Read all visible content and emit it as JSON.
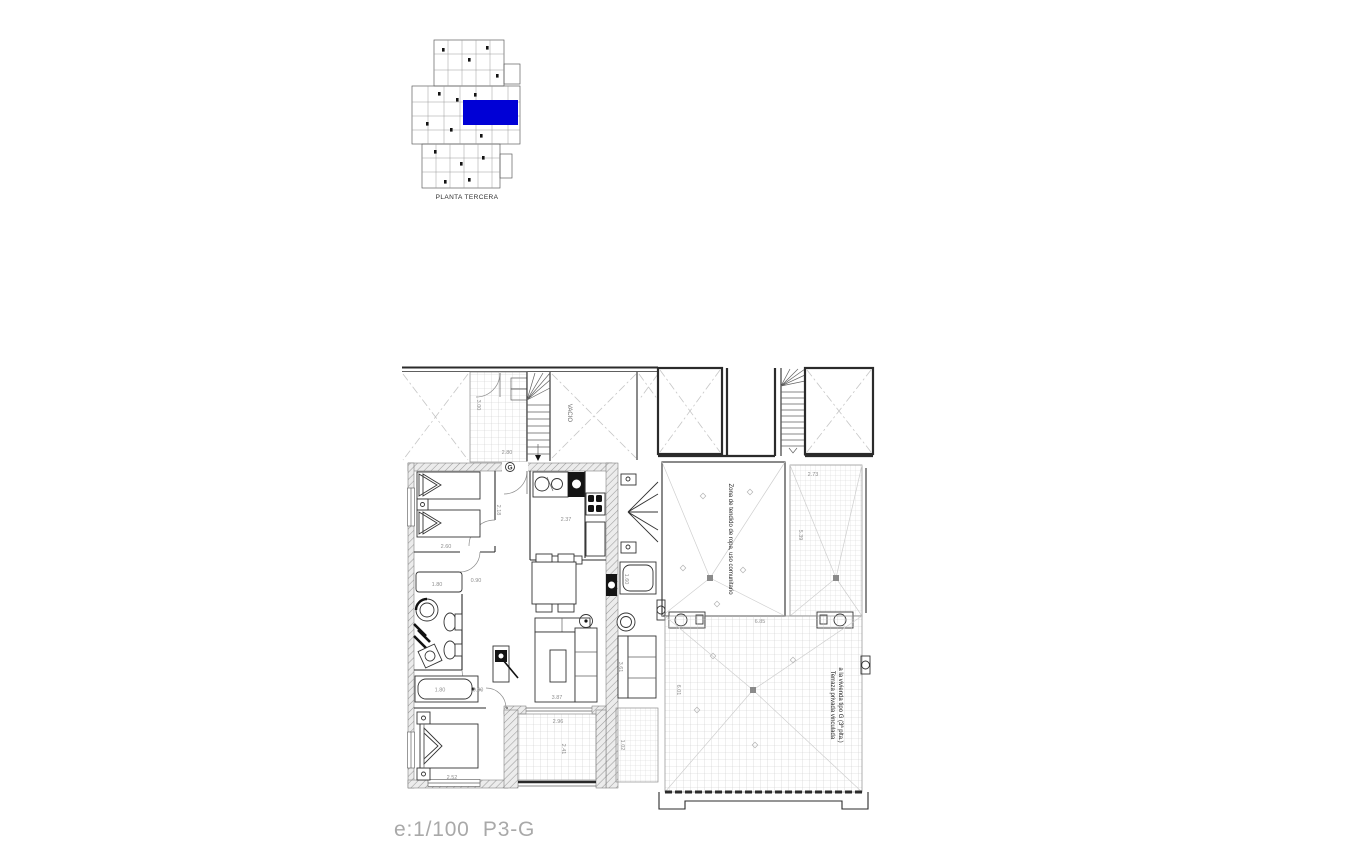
{
  "colors": {
    "highlight": "#0000D6",
    "paper": "#ffffff"
  },
  "key_plan": {
    "caption": "PLANTA TERCERA"
  },
  "footer": {
    "scale_label": "e:1/100  P3-G"
  },
  "unit_plan": {
    "labels": {
      "vacio": "VACIO",
      "unit_letter": "G"
    },
    "dims": {
      "upper_height": "3.00",
      "upper_width": "2.80",
      "hall": "2.18",
      "kitchen": "2.37",
      "bedroom1": "2.60",
      "bath_pass": "0.90",
      "vanity": "1.80",
      "bathtub": "1.80",
      "bath_hall": "0.90",
      "living": "3.87",
      "terrace_w": "2.96",
      "terrace_d": "2.41",
      "bedroom2": "2.52",
      "adj_tub": "1.60",
      "adj_sofa": "3.61",
      "adj_balcony": "1.02"
    }
  },
  "roof_plan": {
    "labels": {
      "zona": "Zona de tendido de ropa, uso comunitario",
      "terraza_line1": "Terraza privada vinculada",
      "terraza_line2": "a la vivienda tipo G (3ª plta.)"
    },
    "dims": {
      "laundry_side": "2.73",
      "laundry_depth": "5.39",
      "terrace_width": "6.85",
      "terrace_depth": "6.01"
    }
  }
}
